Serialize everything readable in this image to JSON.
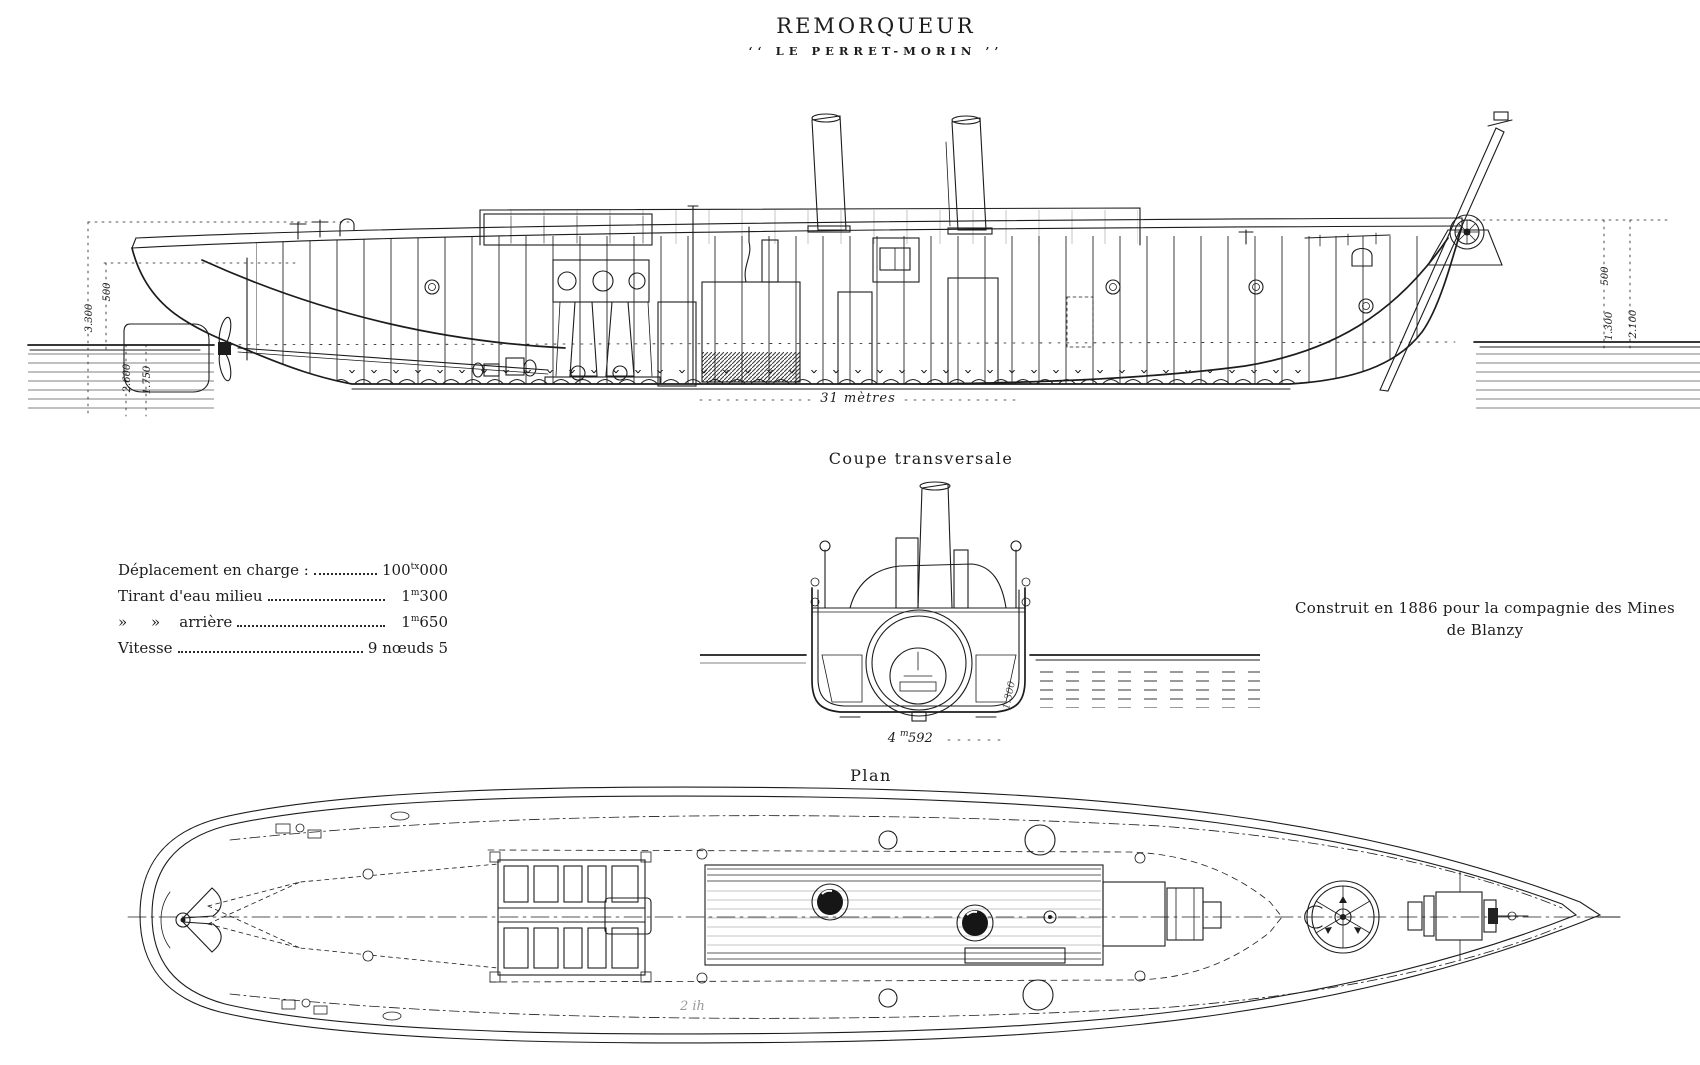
{
  "page": {
    "paper_color": "#ffffff",
    "ink_color": "#1c1c1c"
  },
  "title": {
    "main": "REMORQUEUR",
    "sub": "‘‘ LE PERRET-MORIN ’’"
  },
  "side_view": {
    "length_annotation": "31 mètres",
    "dims_left": [
      "3.300",
      "500",
      "2.600",
      "1.750"
    ],
    "dims_right": [
      "500",
      "1.300",
      "2.100"
    ]
  },
  "section": {
    "label": "Coupe transversale",
    "beam_pre": "4",
    "beam_sup": "m",
    "beam_post": "592",
    "draft_note": "1.300"
  },
  "specs": {
    "rows": [
      {
        "label": "Déplacement en charge :",
        "value_pre": "100",
        "value_sup": "tx",
        "value_post": "000"
      },
      {
        "label": "Tirant d'eau milieu",
        "value_pre": "1",
        "value_sup": "m",
        "value_post": "300"
      },
      {
        "label": "»     »    arrière",
        "value_pre": "1",
        "value_sup": "m",
        "value_post": "650"
      },
      {
        "label": "Vitesse",
        "value_pre": "",
        "value_sup": "",
        "value_post": "9 nœuds 5"
      }
    ]
  },
  "construction_note": {
    "line1": "Construit en 1886 pour la compagnie des Mines",
    "line2": "de Blanzy"
  },
  "plan": {
    "label": "Plan",
    "pencil_note": "2 ih"
  }
}
